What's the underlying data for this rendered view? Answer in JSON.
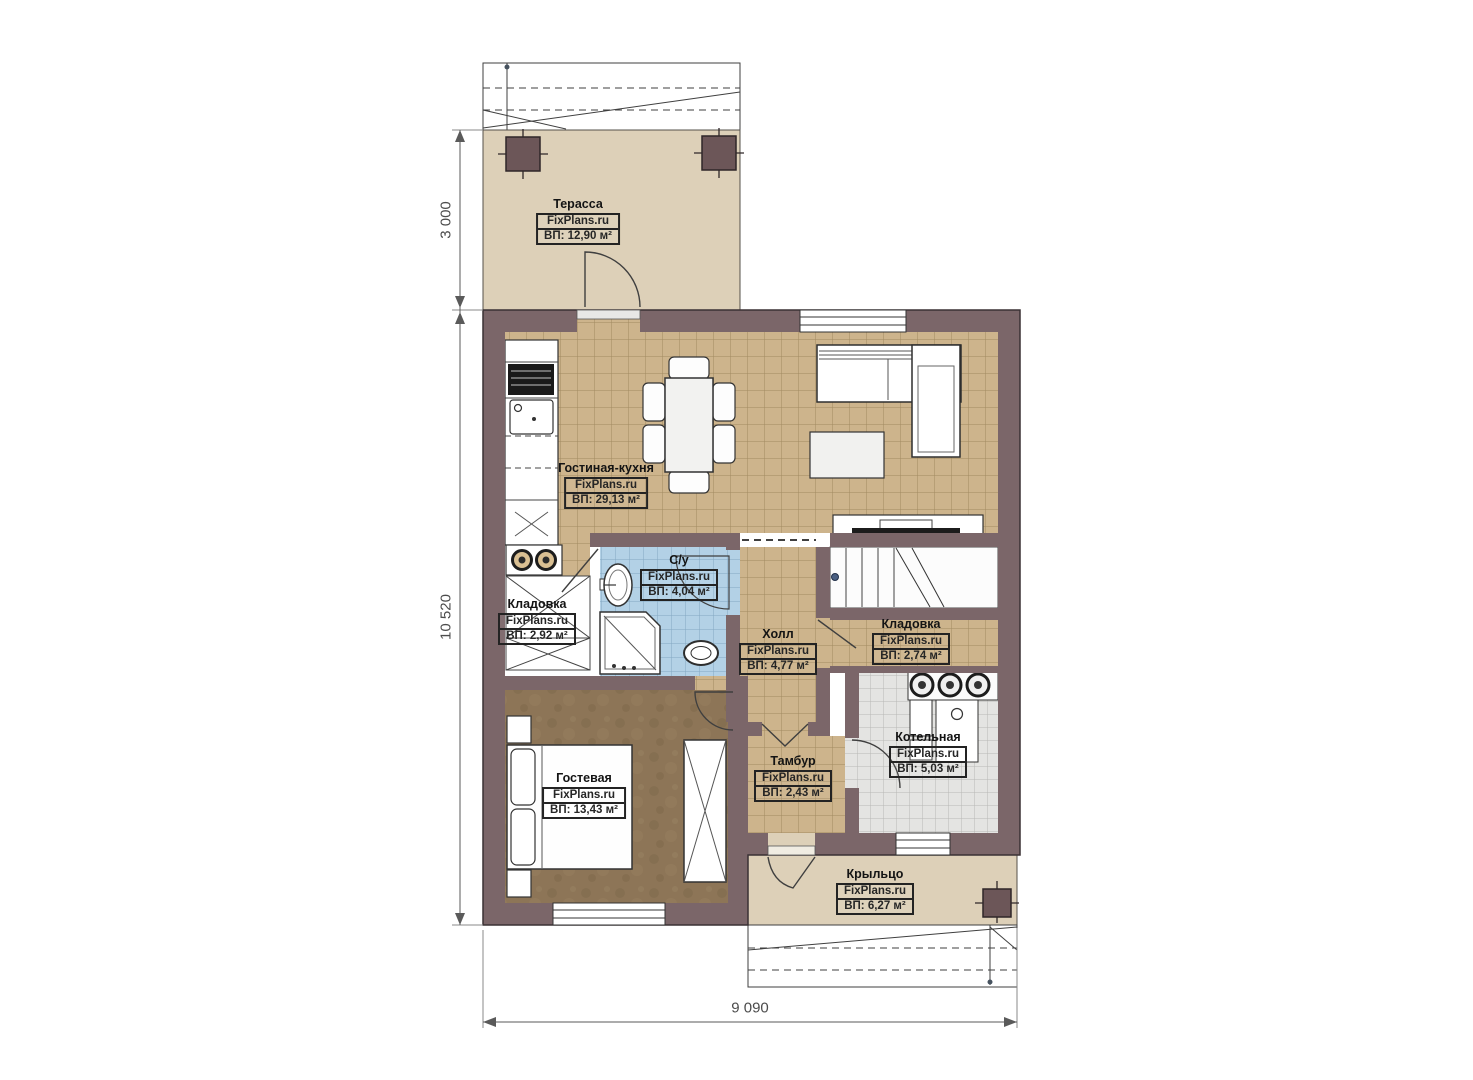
{
  "plan": {
    "watermark": "FixPlans.ru",
    "rooms": [
      {
        "name": "Терасса",
        "area": "ВП: 12,90 м²"
      },
      {
        "name": "Гостиная-кухня",
        "area": "ВП: 29,13 м²"
      },
      {
        "name": "С/у",
        "area": "ВП: 4,04 м²"
      },
      {
        "name": "Кладовка",
        "area": "ВП: 2,92 м²"
      },
      {
        "name": "Холл",
        "area": "ВП: 4,77 м²"
      },
      {
        "name": "Кладовка",
        "area": "ВП: 2,74 м²"
      },
      {
        "name": "Котельная",
        "area": "ВП: 5,03 м²"
      },
      {
        "name": "Гостевая",
        "area": "ВП: 13,43 м²"
      },
      {
        "name": "Тамбур",
        "area": "ВП: 2,43 м²"
      },
      {
        "name": "Крыльцо",
        "area": "ВП: 6,27 м²"
      }
    ],
    "dimensions": {
      "terrace_depth": "3 000",
      "house_height": "10 520",
      "house_width": "9 090"
    },
    "colors": {
      "wall": "#7b6669",
      "terrace_floor": "#ddd0b8",
      "tile_tan": "#cdb48c",
      "tile_blue": "#b3d1e6",
      "tile_gray": "#e4e4e2",
      "guest_floor": "#8d7557"
    }
  }
}
